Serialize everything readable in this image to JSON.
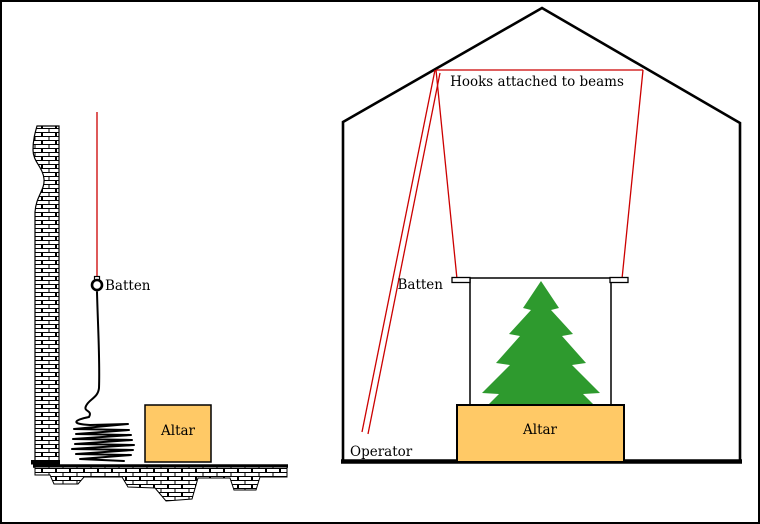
{
  "colors": {
    "rope_red": "#cc0000",
    "tree_green": "#2e9a2e",
    "altar_fill": "#ffc966",
    "line_black": "#000000"
  },
  "side_view": {
    "batten_label": "Batten",
    "altar_label": "Altar"
  },
  "front_view": {
    "hooks_label": "Hooks attached to beams",
    "batten_label": "Batten",
    "operator_label": "Operator",
    "altar_label": "Altar"
  }
}
